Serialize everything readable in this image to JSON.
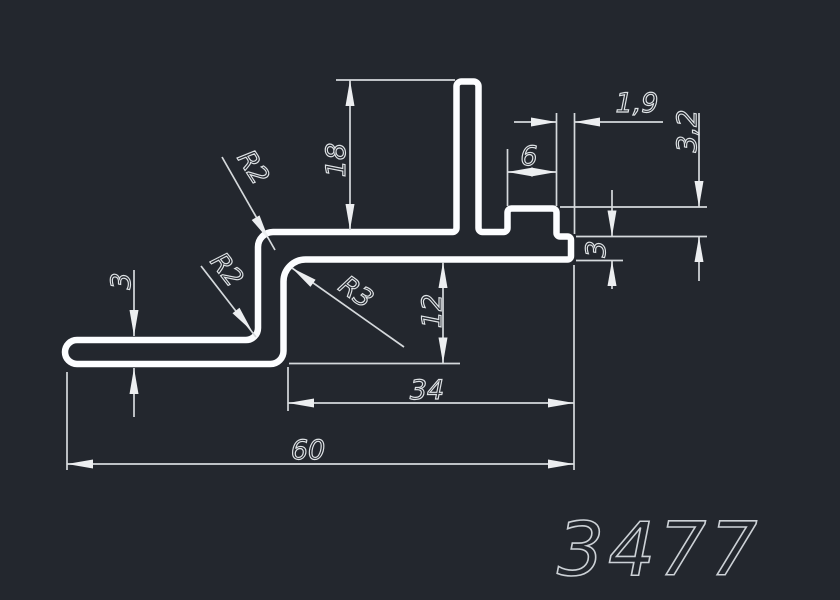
{
  "part_number": "3477",
  "colors": {
    "background": "#23272e",
    "profile_line": "#fcfdff",
    "dimension_line": "#d5d9dc",
    "text": "#dfe3e6"
  },
  "dimensions": {
    "fin_height": "18",
    "top_lip_width": "1,9",
    "boss_height": "3,2",
    "boss_width": "6",
    "right_lip_thickness": "3",
    "foot_thickness": "3",
    "step_depth": "12",
    "web_width": "34",
    "overall_width": "60"
  },
  "radii": {
    "web_top_corner": "R2",
    "foot_corner": "R2",
    "inner_corner": "R3"
  }
}
